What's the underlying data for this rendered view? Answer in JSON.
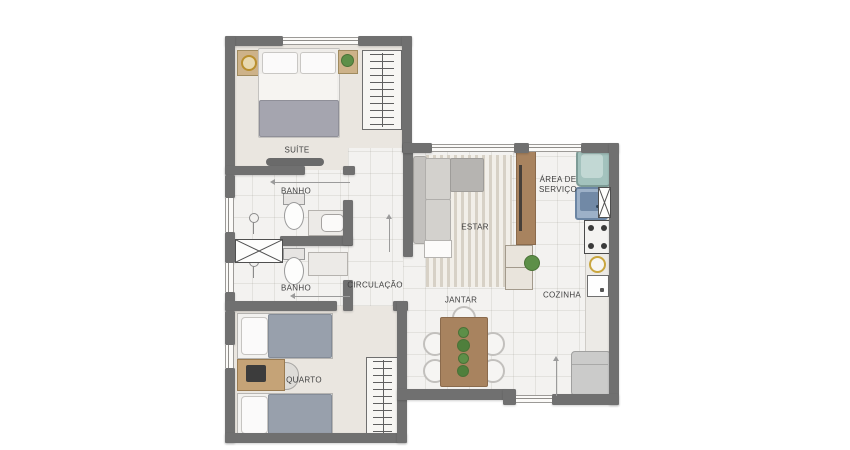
{
  "plan": {
    "title": "apartment-floor-plan",
    "rooms": {
      "suite": "SUÍTE",
      "banho1": "BANHO",
      "banho2": "BANHO",
      "circulacao": "CIRCULAÇÃO",
      "estar": "ESTAR",
      "jantar": "JANTAR",
      "cozinha": "COZINHA",
      "area_servico_line1": "ÁREA DE",
      "area_servico_line2": "SERVIÇO",
      "quarto": "QUARTO"
    },
    "colors": {
      "wall": "#707070",
      "floor_light": "#f3f2f0",
      "floor_bedroom": "#eae6e0",
      "wood": "#a8835f",
      "plant": "#5d8f48",
      "laundry_tub": "#a3c2bd",
      "washer": "#9db1c8",
      "gold": "#c9a63f",
      "bed_blanket": "#98a0ac",
      "label_text": "#3f3f3f"
    }
  }
}
